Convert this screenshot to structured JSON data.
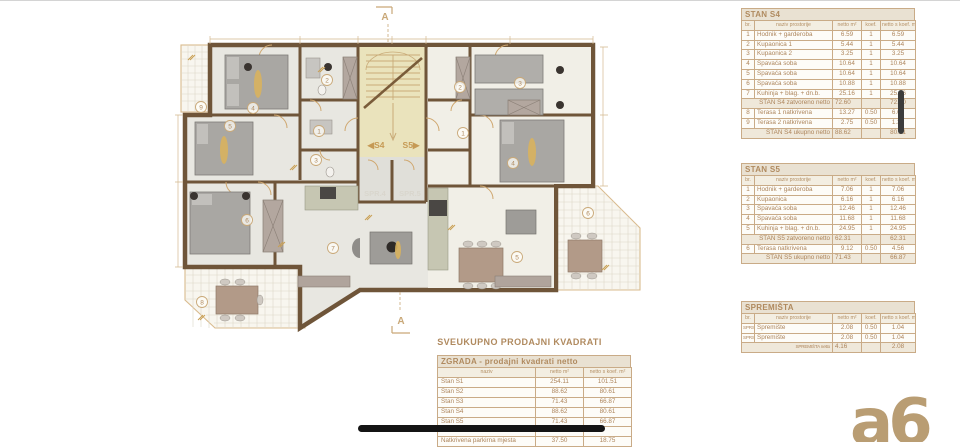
{
  "colors": {
    "accent_tan": "#c9a878",
    "wall_brown": "#6f5539",
    "stair_fill": "#eae3bc",
    "table_text": "#ad855c",
    "marker_black": "#141414",
    "logo_tan": "#b99d73"
  },
  "plan": {
    "section_top": "A",
    "section_bottom": "A",
    "stair_label_left": "◀S4",
    "stair_label_right": "S5▶",
    "spr_left": "SPR.4",
    "spr_right": "SPR.5",
    "left_rooms": [
      "1",
      "2",
      "3",
      "4",
      "5",
      "6",
      "7",
      "8",
      "9"
    ],
    "right_rooms": [
      "1",
      "2",
      "3",
      "4",
      "5",
      "6"
    ]
  },
  "tables": {
    "stan_s4": {
      "title": "STAN S4",
      "columns": [
        "br.",
        "naziv prostorije",
        "netto m²",
        "koef.",
        "netto s koef. m²"
      ],
      "rows": [
        {
          "c": [
            "1",
            "Hodnik + garderoba",
            "6.59",
            "1",
            "6.59"
          ]
        },
        {
          "c": [
            "2",
            "Kupaonica 1",
            "5.44",
            "1",
            "5.44"
          ]
        },
        {
          "c": [
            "3",
            "Kupaonica 2",
            "3.25",
            "1",
            "3.25"
          ]
        },
        {
          "c": [
            "4",
            "Spavaća soba",
            "10.64",
            "1",
            "10.64"
          ]
        },
        {
          "c": [
            "5",
            "Spavaća soba",
            "10.64",
            "1",
            "10.64"
          ]
        },
        {
          "c": [
            "6",
            "Spavaća soba",
            "10.88",
            "1",
            "10.88"
          ]
        },
        {
          "c": [
            "7",
            "Kuhinja + blag. + dn.b.",
            "25.16",
            "1",
            "25.16"
          ]
        },
        {
          "c": [
            "STAN S4 zatvoreno netto",
            "72.60",
            "",
            "72.60"
          ],
          "sum": true
        },
        {
          "c": [
            "8",
            "Terasa 1 natkrivena",
            "13.27",
            "0.50",
            "6.64"
          ]
        },
        {
          "c": [
            "9",
            "Terasa 2 natkrivena",
            "2.75",
            "0.50",
            "1.38"
          ]
        },
        {
          "c": [
            "STAN S4 ukupno netto",
            "88.62",
            "",
            "80.61"
          ],
          "sum": true
        }
      ]
    },
    "stan_s5": {
      "title": "STAN S5",
      "columns": [
        "br.",
        "naziv prostorije",
        "netto m²",
        "koef.",
        "netto s koef. m²"
      ],
      "rows": [
        {
          "c": [
            "1",
            "Hodnik + garderoba",
            "7.06",
            "1",
            "7.06"
          ]
        },
        {
          "c": [
            "2",
            "Kupaonica",
            "6.16",
            "1",
            "6.16"
          ]
        },
        {
          "c": [
            "3",
            "Spavaća soba",
            "12.46",
            "1",
            "12.46"
          ]
        },
        {
          "c": [
            "4",
            "Spavaća soba",
            "11.68",
            "1",
            "11.68"
          ]
        },
        {
          "c": [
            "5",
            "Kuhinja + blag. + dn.b.",
            "24.95",
            "1",
            "24.95"
          ]
        },
        {
          "c": [
            "STAN S5 zatvoreno netto",
            "62.31",
            "",
            "62.31"
          ],
          "sum": true
        },
        {
          "c": [
            "6",
            "Terasa natkrivena",
            "9.12",
            "0.50",
            "4.56"
          ]
        },
        {
          "c": [
            "STAN S5 ukupno netto",
            "71.43",
            "",
            "66.87"
          ],
          "sum": true
        }
      ]
    },
    "spremista": {
      "title": "SPREMIŠTA",
      "columns": [
        "br.",
        "naziv prostorije",
        "netto m²",
        "koef.",
        "netto s koef. m²"
      ],
      "rows": [
        {
          "c": [
            "SPRS4",
            "Spremište",
            "2.08",
            "0.50",
            "1.04"
          ]
        },
        {
          "c": [
            "SPRS5",
            "Spremište",
            "2.08",
            "0.50",
            "1.04"
          ]
        },
        {
          "c": [
            "SPREMIŠTA netto",
            "4.16",
            "",
            "2.08"
          ],
          "sum": true
        }
      ]
    },
    "summary_title": "SVEUKUPNO PRODAJNI KVADRATI",
    "zgrada": {
      "title": "ZGRADA - prodajni kvadrati netto",
      "columns": [
        "naziv",
        "netto m²",
        "netto s koef. m²"
      ],
      "rows": [
        {
          "c": [
            "Stan S1",
            "254.11",
            "101.51"
          ]
        },
        {
          "c": [
            "Stan S2",
            "88.62",
            "80.61"
          ]
        },
        {
          "c": [
            "Stan S3",
            "71.43",
            "66.87"
          ]
        },
        {
          "c": [
            "Stan S4",
            "88.62",
            "80.61"
          ]
        },
        {
          "c": [
            "Stan S5",
            "71.43",
            "66.87"
          ]
        },
        {
          "c": [
            "",
            "",
            ""
          ]
        },
        {
          "c": [
            "Natkrivena parkirna mjesta",
            "37.50",
            "18.75"
          ]
        }
      ]
    }
  },
  "logo_text": "a6"
}
